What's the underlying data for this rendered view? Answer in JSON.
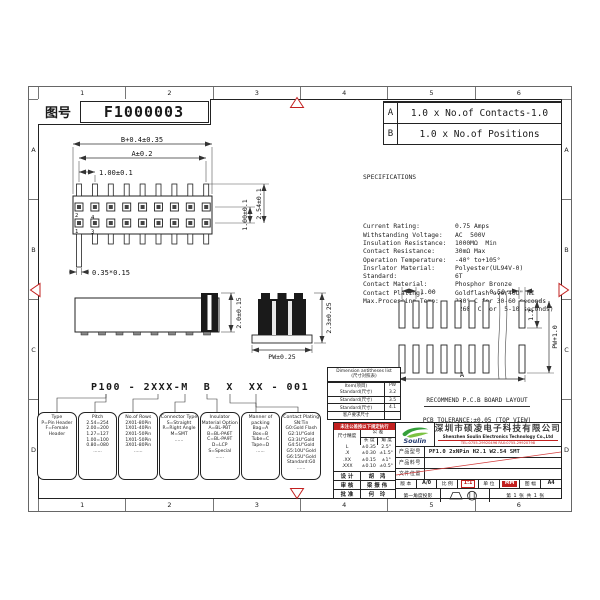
{
  "sheet": {
    "drawing_no_label": "图号",
    "drawing_no": "F1000003"
  },
  "grid": {
    "cols": [
      "1",
      "2",
      "3",
      "4",
      "5",
      "6"
    ],
    "rows": [
      "A",
      "B",
      "C",
      "D"
    ]
  },
  "revision": {
    "rows": [
      {
        "key": "A",
        "text": "1.0 x No.of Contacts-1.0"
      },
      {
        "key": "B",
        "text": "1.0 x No.of Positions"
      }
    ]
  },
  "spec": {
    "title": "SPECIFICATIONS",
    "rows": [
      {
        "label": "Current Rating:",
        "value": "0.75 Amps"
      },
      {
        "label": "Withstanding Voltage:",
        "value": "AC  500V"
      },
      {
        "label": "Insulation Resistance:",
        "value": "1000MΩ  Min"
      },
      {
        "label": "Contact Resistance:",
        "value": "30mΩ Max"
      },
      {
        "label": "Operation Temperature:",
        "value": "-40° to+105°"
      },
      {
        "label": "Insrlator Material:",
        "value": "Polyester(UL94V-0)"
      },
      {
        "label": "Standard:",
        "value": "6T"
      },
      {
        "label": "Contact Material:",
        "value": "Phosphor Bronze"
      },
      {
        "label": "Contact Plating:",
        "value": "Goldflash over40U\" Ni"
      },
      {
        "label": "Max.Processing Temp:",
        "value": "230° C for 30-60 seconds"
      },
      {
        "label": "",
        "value": "(260° C for  5-10 seconds)"
      }
    ]
  },
  "top_view": {
    "dim_body_width": "B+0.4±0.35",
    "dim_pin_span": "A±0.2",
    "dim_pitch": "1.00±0.1",
    "dim_row_pitch": "1.00±0.1",
    "dim_overall": "2.54±0.1",
    "dim_pin_size": "0.35*0.15",
    "pin1": "1",
    "pin2": "2",
    "pin3": "3",
    "pin4": "4"
  },
  "side_view": {
    "dim_height": "2.0±0.15"
  },
  "end_view": {
    "dim_height": "2.3±0.25",
    "dim_width": "PW±0.25"
  },
  "pcb": {
    "dim_pitch": "1.00",
    "dim_pad_width": "0.50",
    "dim_pad_length": "1.2",
    "dim_row_span": "PW+1.0",
    "dim_total": "A",
    "caption1": "RECOMMEND P.C.B BOARD LAYOUT",
    "caption2": "PCB TOLERANCE:±0.05 (TOP VIEW)"
  },
  "part_number": {
    "code": "P100 - 2XXX-M  B  X  XX - 001",
    "boxes": [
      {
        "title": "Type",
        "lines": [
          "P=Pin Header",
          "F=Female Header"
        ]
      },
      {
        "title": "Pitch",
        "lines": [
          "2.54=254",
          "2.00=200",
          "1.27=127",
          "1.00=100",
          "0.80=080",
          "......"
        ]
      },
      {
        "title": "No.of Rows",
        "lines": [
          "2X01-80Pin",
          "1X01-40Pin",
          "2X01-50Pin",
          "1X01-50Pin",
          "3X01-80Pin",
          "......"
        ]
      },
      {
        "title": "Connector Type",
        "lines": [
          "S=Straight",
          "R=Right Angle",
          "M=SMT",
          "......"
        ]
      },
      {
        "title": "Insulator Material Option",
        "lines": [
          "A=BL-PBT",
          "B=BL-PA6T",
          "C=BL-PA9T",
          "D=LCP",
          "S=Special",
          "......"
        ]
      },
      {
        "title": "Manner of packing",
        "lines": [
          "Bag=A",
          "Box=B",
          "Tube=C",
          "Tape=D",
          "......"
        ]
      },
      {
        "title": "Contact Plating",
        "lines": [
          "SN:Tin",
          "G0:Gold Flash",
          "G2:1U\"Gold",
          "G3:3U\"Gold",
          "G4:5U\"Gold",
          "G5:10U\"Gold",
          "G6:15U\"Gold",
          "Standard:G0",
          "......"
        ]
      }
    ]
  },
  "pw_table": {
    "title1": "Dimension antitheses list",
    "title2": "(尺寸对照表)",
    "col_item": "Item(项目)",
    "col_pw": "PW",
    "rows": [
      [
        "Standard(尺寸)",
        "3.2"
      ],
      [
        "Standard(尺寸)",
        "3.5"
      ],
      [
        "Standard(尺寸)",
        "4.1"
      ]
    ],
    "footer": "客户要求尺寸"
  },
  "title_block": {
    "note": "未注公差按以下规定执行",
    "tol": {
      "corner": "尺寸精度",
      "span": "公 差",
      "len": "长 度",
      "ang": "角 度"
    },
    "tol_rows": [
      [
        "L",
        "±0.35",
        "2.5°"
      ],
      [
        ".X",
        "±0.30",
        "±1.5°"
      ],
      [
        ".XX",
        "±0.15",
        "±1°"
      ],
      [
        ".XXX",
        "±0.10",
        "±0.5°"
      ]
    ],
    "sign_rows": [
      [
        "设 计",
        "胡 鸿"
      ],
      [
        "审 核",
        "梁振伟"
      ],
      [
        "批 准",
        "何 玲"
      ]
    ],
    "logo_text": "Soulin",
    "company_cn": "深圳市硕凌电子科技有限公司",
    "company_en": "Shenzhen Soulin Electronics Technology Co.,Ltd",
    "contact": "TEL:0755-29920496  FAX:0755-29920798",
    "info_rows": [
      {
        "label": "产品型号",
        "value": "PF1.0 2xNPin H2.1 W2.54 SMT"
      },
      {
        "label": "产品料号",
        "value": ""
      },
      {
        "label": "文件位置",
        "value": ""
      }
    ],
    "version": {
      "label": "版 本",
      "value": "A/0"
    },
    "scale": {
      "label": "比 例",
      "value": "1:1"
    },
    "unit": {
      "label": "单 位",
      "value": "MM"
    },
    "size": {
      "label": "图 幅",
      "value": "A4"
    },
    "projection": {
      "label": "第一角度投影",
      "sheet": "第 1 张 共 1 张"
    }
  }
}
